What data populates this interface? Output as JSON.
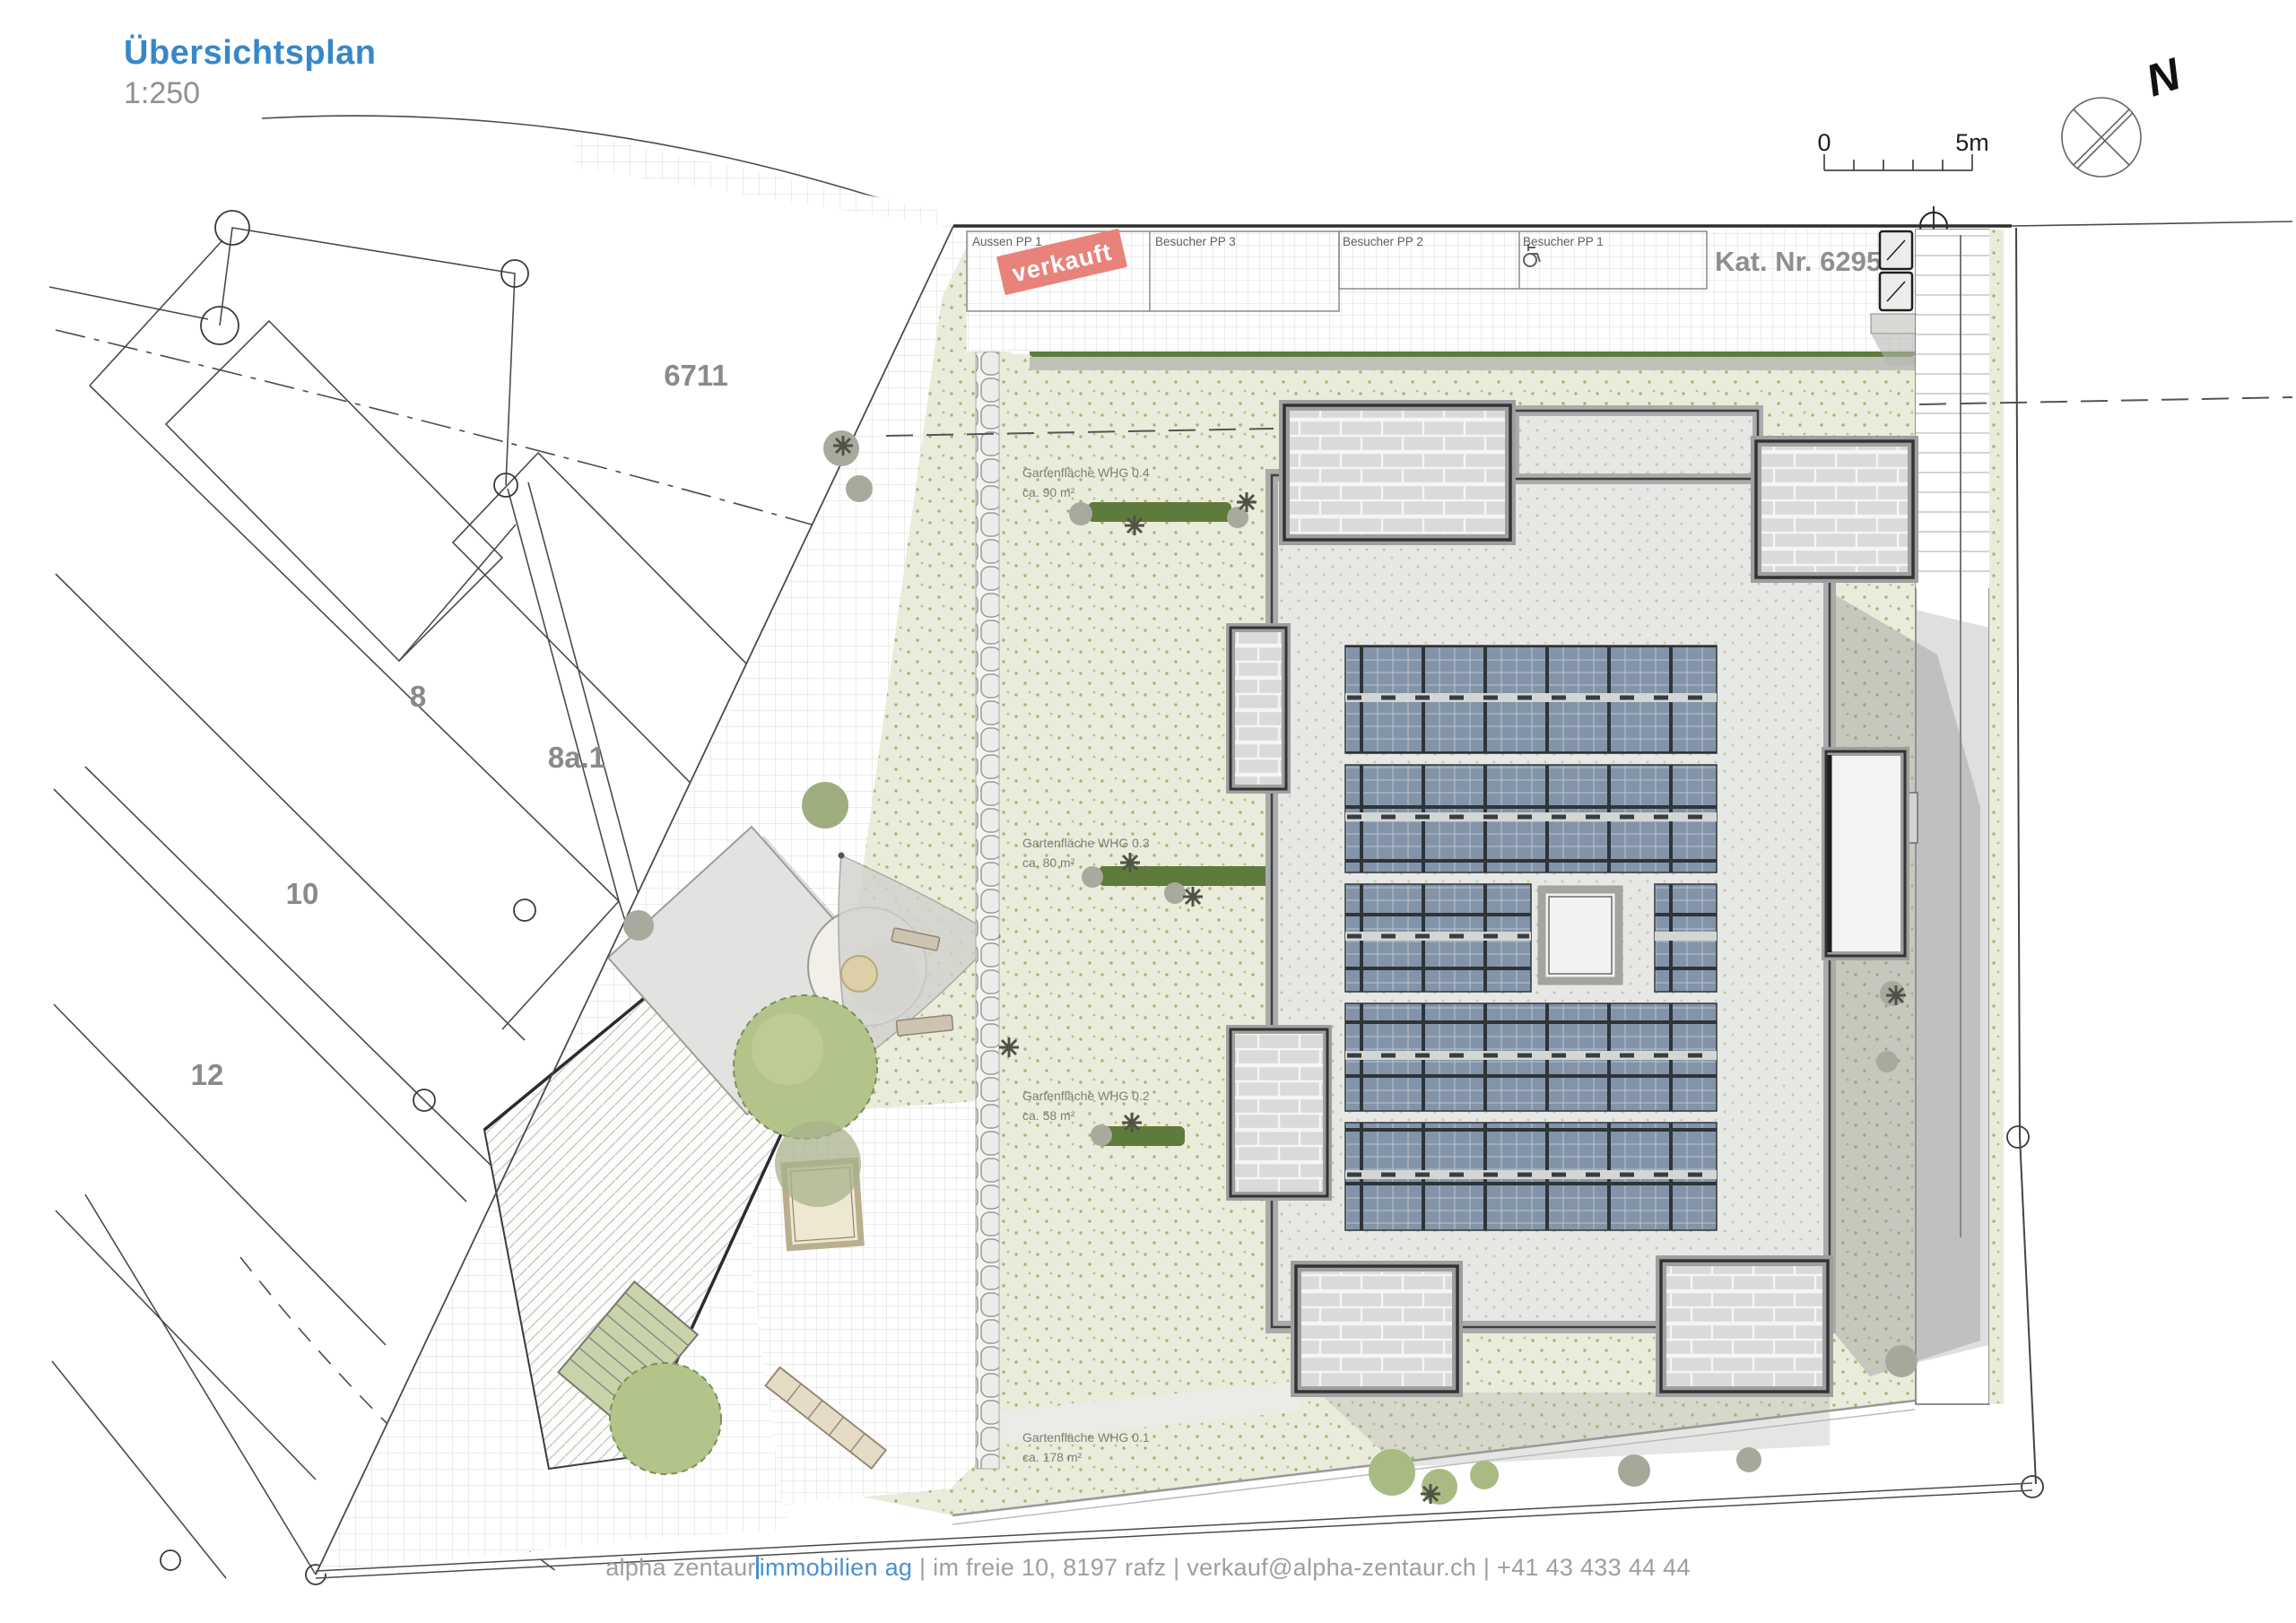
{
  "title": {
    "main": "Übersichtsplan",
    "scale": "1:250"
  },
  "north_arrow": {
    "label": "N"
  },
  "scale_bar": {
    "start_label": "0",
    "end_label": "5m"
  },
  "cadastre": {
    "label": "Kat. Nr. 6295"
  },
  "sold_stamp": {
    "label": "verkauft"
  },
  "parking": {
    "stalls": [
      {
        "label": "Aussen PP 1",
        "status": "verkauft"
      },
      {
        "label": "Besucher PP 3"
      },
      {
        "label": "Besucher PP 2"
      },
      {
        "label": "Besucher PP 1",
        "accessible": true
      }
    ]
  },
  "parcels": [
    {
      "label": "6711"
    },
    {
      "label": "8a.1"
    },
    {
      "label": "8"
    },
    {
      "label": "10"
    },
    {
      "label": "12"
    }
  ],
  "garden_areas": [
    {
      "name": "Gartenfläche WHG 0.4",
      "area": "ca. 90 m²"
    },
    {
      "name": "Gartenfläche WHG 0.3",
      "area": "ca. 80 m²"
    },
    {
      "name": "Gartenfläche WHG 0.2",
      "area": "ca. 58 m²"
    },
    {
      "name": "Gartenfläche WHG 0.1",
      "area": "ca. 178 m²"
    }
  ],
  "footer": {
    "company": "alpha zentaur",
    "brand": "immobilien ag",
    "sep": " | ",
    "address": "im freie 10, 8197 rafz",
    "email": "verkauf@alpha-zentaur.ch",
    "phone": "+41 43 433 44 44"
  },
  "colors": {
    "accent_blue": "#3787c9",
    "text_gray": "#8f8f8f",
    "sold_red": "#e8837c",
    "garden_green": "#e9ecda",
    "hedge_green": "#5f7b3c",
    "solar_panel": "#8394a9",
    "roof_gray": "#e6e8e5",
    "brick_gray": "#dadad8",
    "line_dark": "#3f3f3f"
  }
}
